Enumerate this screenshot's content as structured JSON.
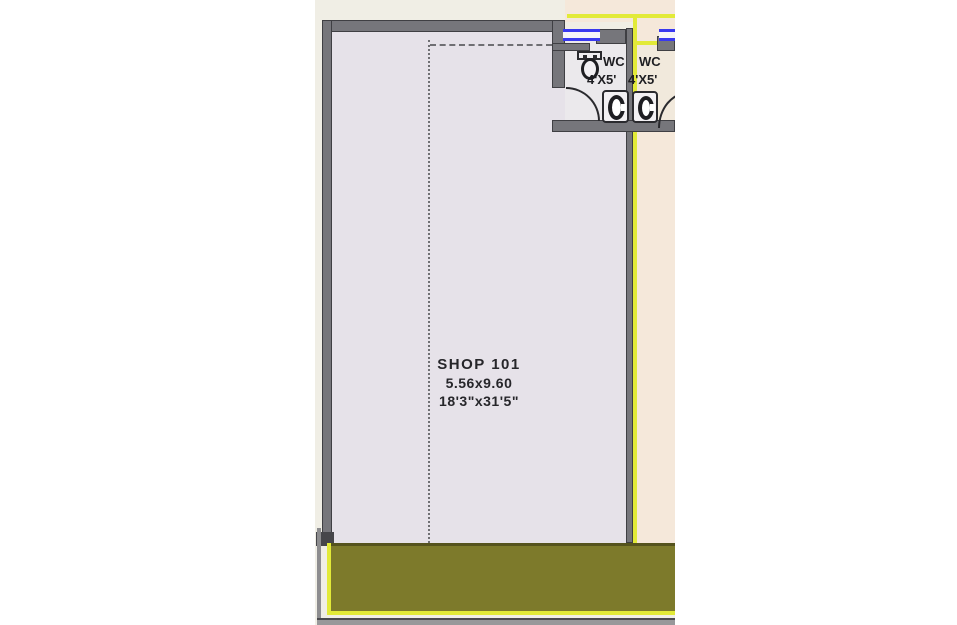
{
  "shop": {
    "name": "SHOP  101",
    "size_meters": "5.56x9.60",
    "size_feet": "18'3\"x31'5\""
  },
  "wc_left": {
    "label": "WC",
    "size": "4'X5'"
  },
  "wc_right": {
    "label": "WC",
    "size": "4'X5'"
  },
  "colors": {
    "wall_gray": "#76767b",
    "wall_outline": "#3f3f43",
    "shop_fill": "#e6e2e9",
    "adjacent_fill": "#f5e8da",
    "highlight_yellow": "#e2ea38",
    "road_olive": "#7d7a2b",
    "window_blue": "#3939ef",
    "sheet_beige": "#f0eee5",
    "text_dark": "#26262a"
  }
}
